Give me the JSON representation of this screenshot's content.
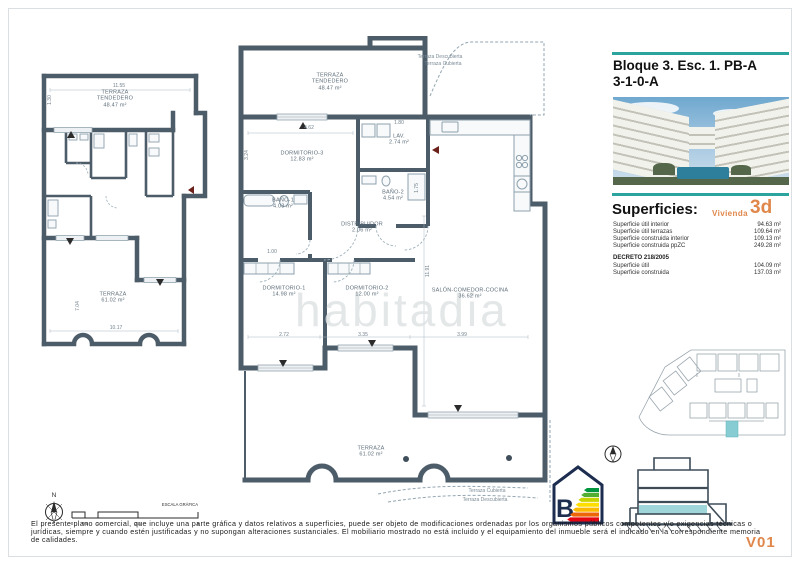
{
  "meta": {
    "watermark": "habitadia",
    "version": "V01"
  },
  "colors": {
    "teal": "#2aa49c",
    "orange": "#e0874b",
    "wall": "#4d5c69",
    "highlight": "#86ccd2"
  },
  "header": {
    "line1": "Bloque 3. Esc. 1. PB-A",
    "line2": "3-1-0-A"
  },
  "superficies": {
    "heading": "Superficies:",
    "vivienda_label": "Vivienda",
    "vivienda_code": "3d",
    "rows": [
      {
        "label": "Superficie útil interior",
        "value": "94.63 m²"
      },
      {
        "label": "Superficie útil terrazas",
        "value": "109.64 m²"
      },
      {
        "label": "Superficie construida interior",
        "value": "109.13 m²"
      },
      {
        "label": "Superficie construida ppZC",
        "value": "249.28 m²"
      }
    ],
    "decreto_heading": "DECRETO 218/2005",
    "decreto_rows": [
      {
        "label": "Superficie útil",
        "value": "104.09 m²"
      },
      {
        "label": "Superficie construida",
        "value": "137.03 m²"
      }
    ]
  },
  "main_plan": {
    "rooms": [
      {
        "line1": "TERRAZA",
        "line2": "TENDEDERO",
        "area": "48.47 m²"
      },
      {
        "line1": "DORMITORIO-3",
        "line2": "",
        "area": "12.83 m²"
      },
      {
        "line1": "LAV.",
        "line2": "",
        "area": "2.74 m²"
      },
      {
        "line1": "BAÑO-2",
        "line2": "",
        "area": "4.54 m²"
      },
      {
        "line1": "BAÑO-1",
        "line2": "",
        "area": "4.03 m²"
      },
      {
        "line1": "DISTRIBUIDOR",
        "line2": "",
        "area": "2.06 m²"
      },
      {
        "line1": "DORMITORIO-1",
        "line2": "",
        "area": "14.98 m²"
      },
      {
        "line1": "DORMITORIO-2",
        "line2": "",
        "area": "12.00 m²"
      },
      {
        "line1": "SALÓN-COMEDOR-COCINA",
        "line2": "",
        "area": "36.62 m²"
      },
      {
        "line1": "TERRAZA",
        "line2": "",
        "area": "61.02 m²"
      }
    ],
    "dims": {
      "d462": "4.62",
      "d180": "1.80",
      "d324": "3.24",
      "d1191": "11.91",
      "d272": "2.72",
      "d335": "3.35",
      "d399": "3.99",
      "d100": "1.00",
      "d175": "1.75"
    },
    "notes_top": [
      "Terraza Descubierta",
      "Terraza Cubierta"
    ],
    "notes_bottom": [
      "Terraza Cubierta",
      "Terraza Descubierta"
    ]
  },
  "small_plan": {
    "rooms": [
      {
        "line1": "TERRAZA",
        "line2": "TENDEDERO",
        "area": "48.47 m²"
      },
      {
        "line1": "TERRAZA",
        "line2": "",
        "area": "61.02 m²"
      }
    ],
    "dims": {
      "d1155": "11.55",
      "d130": "1.30",
      "d704": "7.04",
      "d1017": "10.17"
    }
  },
  "energy": {
    "letter": "B",
    "colors": [
      "#009640",
      "#52ae32",
      "#c8d400",
      "#ffde00",
      "#fbba00",
      "#ec6608",
      "#e30613"
    ]
  },
  "footer": {
    "north_label": "N",
    "scale_label": "ESCALA GRÁFICA",
    "scale_ticks": [
      "0",
      "0.5",
      "1",
      "2.5",
      "5"
    ],
    "disclaimer": "El presente plano comercial, que incluye una parte gráfica y datos relativos a superficies, puede ser objeto de modificaciones ordenadas por los organismos públicos competentes y/o exigencias técnicas o jurídicas, siempre y cuando estén justificadas y no supongan alteraciones sustanciales. El mobiliario mostrado no está incluido y el equipamiento del inmueble será el indicado en la correspondiente memoria de calidades."
  }
}
